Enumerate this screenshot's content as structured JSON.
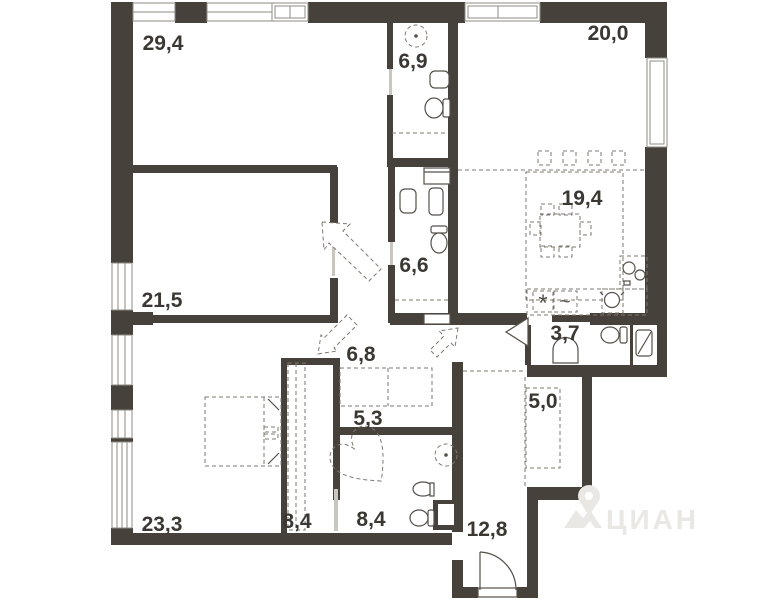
{
  "rooms": [
    {
      "id": "living-room",
      "label": "29,4"
    },
    {
      "id": "bathroom-top",
      "label": "6,9"
    },
    {
      "id": "bedroom-right",
      "label": "20,0"
    },
    {
      "id": "kitchen-zone",
      "label": "19,4"
    },
    {
      "id": "bedroom-left",
      "label": "21,5"
    },
    {
      "id": "bathroom-middle",
      "label": "6,6"
    },
    {
      "id": "wc-small",
      "label": "3,7"
    },
    {
      "id": "hall-upper",
      "label": "6,8"
    },
    {
      "id": "closet-5-3",
      "label": "5,3"
    },
    {
      "id": "closet-5-0",
      "label": "5,0"
    },
    {
      "id": "bedroom-bottom",
      "label": "23,3"
    },
    {
      "id": "wardrobe-left",
      "label": "8,4"
    },
    {
      "id": "bathroom-bottom",
      "label": "8,4"
    },
    {
      "id": "hallway-entry",
      "label": "12,8"
    }
  ],
  "symbols": {
    "fridge": "*",
    "washer": "~"
  },
  "watermark": {
    "brand": "ЦИАН"
  },
  "colors": {
    "wall": "#46413b",
    "line": "#55504a",
    "dashed": "#7d786f",
    "glass": "#c9c6c0",
    "label": "#3b3733",
    "watermark": "#eae8e4",
    "background": "#ffffff"
  }
}
